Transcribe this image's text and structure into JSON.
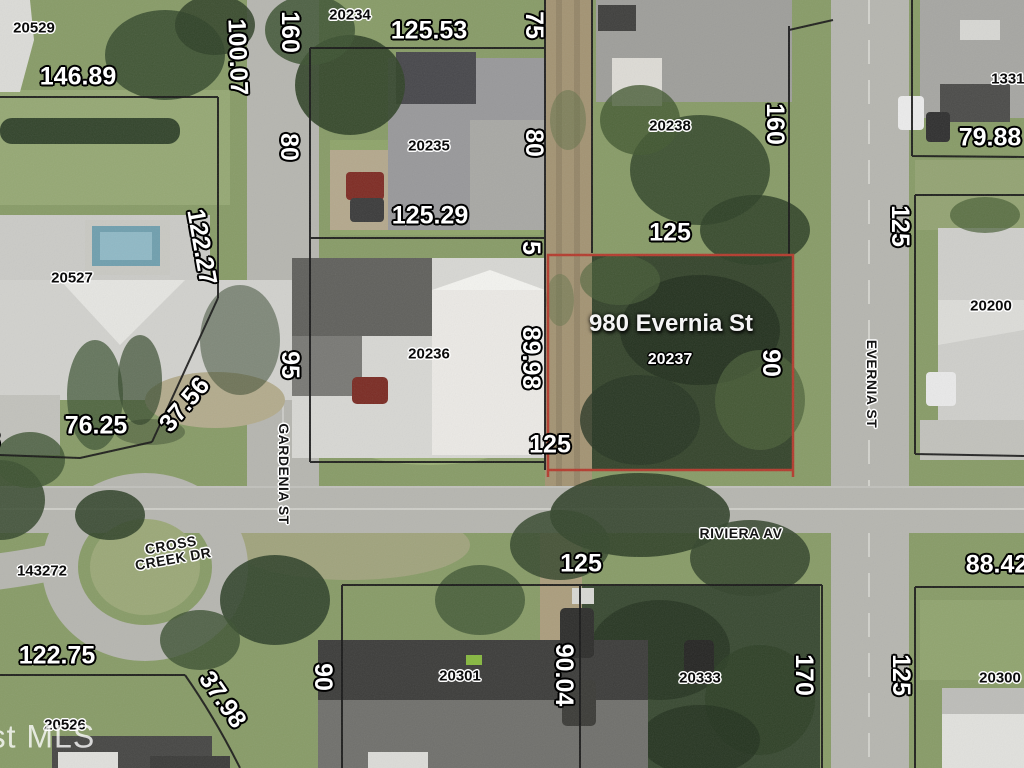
{
  "highlight": {
    "address": "980 Evernia St",
    "parcel_id": "20237",
    "outline_color": "#b43a2c"
  },
  "watermark": "ast MLS",
  "labels": [
    {
      "name": "dim-20529-south",
      "cls": "dim",
      "text": "146.89",
      "x": 78,
      "y": 77,
      "rot": 0
    },
    {
      "name": "dim-gardenia-north",
      "cls": "dim",
      "text": "100.07",
      "x": 237,
      "y": 57,
      "rot": 88
    },
    {
      "name": "dim-20234-west",
      "cls": "dim",
      "text": "160",
      "x": 289,
      "y": 32,
      "rot": 90
    },
    {
      "name": "dim-20234-north",
      "cls": "dim",
      "text": "125.53",
      "x": 429,
      "y": 31,
      "rot": 0
    },
    {
      "name": "dim-20234-east",
      "cls": "dim",
      "text": "75",
      "x": 533,
      "y": 25,
      "rot": 90
    },
    {
      "name": "dim-20235-west",
      "cls": "dim",
      "text": "80",
      "x": 288,
      "y": 147,
      "rot": 90
    },
    {
      "name": "dim-20235-east",
      "cls": "dim",
      "text": "80",
      "x": 533,
      "y": 143,
      "rot": 90
    },
    {
      "name": "dim-20235-south",
      "cls": "dim",
      "text": "125.29",
      "x": 430,
      "y": 216,
      "rot": 0
    },
    {
      "name": "dim-alley",
      "cls": "dim",
      "text": "5",
      "x": 530,
      "y": 248,
      "rot": 90
    },
    {
      "name": "dim-20527-east",
      "cls": "dim",
      "text": "122.27",
      "x": 201,
      "y": 247,
      "rot": 80
    },
    {
      "name": "dim-20236-west",
      "cls": "dim",
      "text": "95",
      "x": 289,
      "y": 365,
      "rot": 90
    },
    {
      "name": "dim-20236-east",
      "cls": "dim",
      "text": "89.98",
      "x": 530,
      "y": 358,
      "rot": 90
    },
    {
      "name": "dim-20527-southeast",
      "cls": "dim",
      "text": "37.56",
      "x": 185,
      "y": 405,
      "rot": -50
    },
    {
      "name": "dim-20527-south",
      "cls": "dim",
      "text": "76.25",
      "x": 96,
      "y": 426,
      "rot": 0
    },
    {
      "name": "dim-20237-south",
      "cls": "dim",
      "text": "125",
      "x": 550,
      "y": 445,
      "rot": 0
    },
    {
      "name": "dim-20237-north",
      "cls": "dim",
      "text": "125",
      "x": 670,
      "y": 233,
      "rot": 0
    },
    {
      "name": "dim-20237-east",
      "cls": "dim",
      "text": "90",
      "x": 770,
      "y": 363,
      "rot": 90
    },
    {
      "name": "dim-20238-east",
      "cls": "dim",
      "text": "160",
      "x": 774,
      "y": 124,
      "rot": 90
    },
    {
      "name": "dim-20200-west",
      "cls": "dim",
      "text": "125",
      "x": 899,
      "y": 226,
      "rot": 90
    },
    {
      "name": "dim-79-88",
      "cls": "dim",
      "text": "79.88",
      "x": 990,
      "y": 138,
      "rot": 0
    },
    {
      "name": "dim-20526-north",
      "cls": "dim",
      "text": "122.75",
      "x": 57,
      "y": 656,
      "rot": 0
    },
    {
      "name": "dim-20526-east",
      "cls": "dim",
      "text": "37.98",
      "x": 222,
      "y": 700,
      "rot": 55
    },
    {
      "name": "dim-20301-west",
      "cls": "dim",
      "text": "90",
      "x": 322,
      "y": 677,
      "rot": 90
    },
    {
      "name": "dim-20301-east",
      "cls": "dim",
      "text": "90.04",
      "x": 563,
      "y": 675,
      "rot": 90
    },
    {
      "name": "dim-20301-north",
      "cls": "dim",
      "text": "125",
      "x": 581,
      "y": 564,
      "rot": 0
    },
    {
      "name": "dim-20333-east",
      "cls": "dim",
      "text": "170",
      "x": 803,
      "y": 675,
      "rot": 90
    },
    {
      "name": "dim-20300-west",
      "cls": "dim",
      "text": "125",
      "x": 900,
      "y": 675,
      "rot": 90
    },
    {
      "name": "dim-20300-north",
      "cls": "dim",
      "text": "88.42",
      "x": 997,
      "y": 565,
      "rot": 0
    },
    {
      "name": "dim-cut-left-edge",
      "cls": "dim",
      "text": "8",
      "x": -7,
      "y": 441,
      "rot": 0
    },
    {
      "name": "parcel-id-20529",
      "cls": "pid",
      "text": "20529",
      "x": 34,
      "y": 28,
      "rot": 0
    },
    {
      "name": "parcel-id-20234",
      "cls": "pid",
      "text": "20234",
      "x": 350,
      "y": 15,
      "rot": 0
    },
    {
      "name": "parcel-id-20235",
      "cls": "pid",
      "text": "20235",
      "x": 429,
      "y": 146,
      "rot": 0
    },
    {
      "name": "parcel-id-20236",
      "cls": "pid",
      "text": "20236",
      "x": 429,
      "y": 354,
      "rot": 0
    },
    {
      "name": "parcel-id-20238",
      "cls": "pid",
      "text": "20238",
      "x": 670,
      "y": 126,
      "rot": 0
    },
    {
      "name": "parcel-id-20527",
      "cls": "pid",
      "text": "20527",
      "x": 72,
      "y": 278,
      "rot": 0
    },
    {
      "name": "parcel-id-20200",
      "cls": "pid",
      "text": "20200",
      "x": 991,
      "y": 306,
      "rot": 0
    },
    {
      "name": "parcel-id-13312",
      "cls": "pid",
      "text": "13312",
      "x": 1012,
      "y": 79,
      "rot": 0
    },
    {
      "name": "parcel-id-143272",
      "cls": "pid",
      "text": "143272",
      "x": 42,
      "y": 571,
      "rot": 0
    },
    {
      "name": "parcel-id-20526",
      "cls": "pid",
      "text": "20526",
      "x": 65,
      "y": 725,
      "rot": 0
    },
    {
      "name": "parcel-id-20301",
      "cls": "pid",
      "text": "20301",
      "x": 460,
      "y": 676,
      "rot": 0
    },
    {
      "name": "parcel-id-20333",
      "cls": "pid",
      "text": "20333",
      "x": 700,
      "y": 678,
      "rot": 0
    },
    {
      "name": "parcel-id-20300",
      "cls": "pid",
      "text": "20300",
      "x": 1000,
      "y": 678,
      "rot": 0
    },
    {
      "name": "street-gardenia",
      "cls": "street",
      "text": "GARDENIA ST",
      "x": 284,
      "y": 474,
      "rot": 90
    },
    {
      "name": "street-evernia",
      "cls": "street",
      "text": "EVERNIA ST",
      "x": 872,
      "y": 384,
      "rot": 90
    },
    {
      "name": "street-riviera",
      "cls": "street",
      "text": "RIVIERA AV",
      "x": 741,
      "y": 533,
      "rot": 0
    },
    {
      "name": "street-cross-creek",
      "cls": "street",
      "text": "CROSS\nCREEK DR",
      "x": 172,
      "y": 552,
      "rot": -10
    }
  ]
}
